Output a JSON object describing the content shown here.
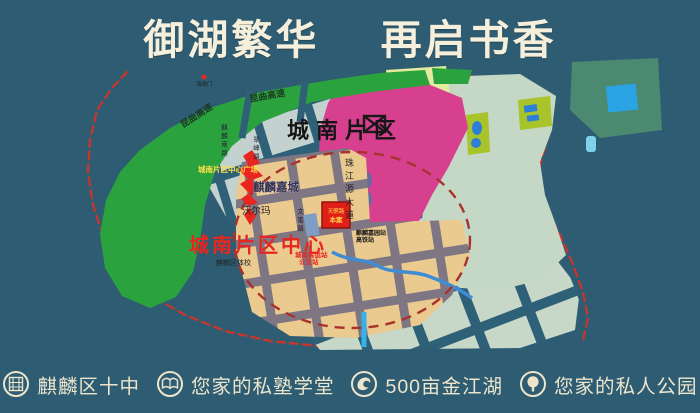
{
  "title": "御湖繁华　 再启书香",
  "map": {
    "district_label": "城南片区",
    "center_label": "城南片区中心",
    "plaza_label": "城南片区中心广场",
    "jiacheng_label": "麒麟嘉城",
    "walmart_label": "沃尔玛",
    "expressway_label_left": "昆曲高速",
    "expressway_label_right": "昆曲高速",
    "avenue_label": "珠江源大道",
    "road_label_1": "麒麟南路",
    "road_label_2": "翠峰路",
    "road_label_3": "文笔路",
    "sports_school_label": "麒麟区体校",
    "station_label_line1": "麒麟嘉园站",
    "station_label_line2": "高铁站",
    "note_label_line1": "城南客运站",
    "note_label_line2": "公交站",
    "site_label_line1": "天麒路",
    "site_label_line2": "本案",
    "gate_label": "海埂门"
  },
  "legend": {
    "items": [
      {
        "icon": "seal-icon",
        "label": "麒麟区十中"
      },
      {
        "icon": "book-icon",
        "label": "您家的私塾学堂"
      },
      {
        "icon": "wave-icon",
        "label": "500亩金江湖"
      },
      {
        "icon": "tree-icon",
        "label": "您家的私人公园"
      }
    ]
  },
  "colors": {
    "background": "#2e5d73",
    "title_text": "#f6efdc",
    "map_green": "#2aa23e",
    "district_pink": "#d6408f",
    "center_blocks_tan": "#ebca90",
    "center_roads_gray": "#7e7683",
    "pale_blocks": "#c3d2cf",
    "sage_blocks": "#c5d8c6",
    "olive_green": "#a9c32b",
    "lake_blue": "#2e7fd6",
    "purple_lake": "#67699f",
    "boundary_red": "#c9342b",
    "accent_red": "#e8251f",
    "legend_text": "#ece5cc"
  }
}
